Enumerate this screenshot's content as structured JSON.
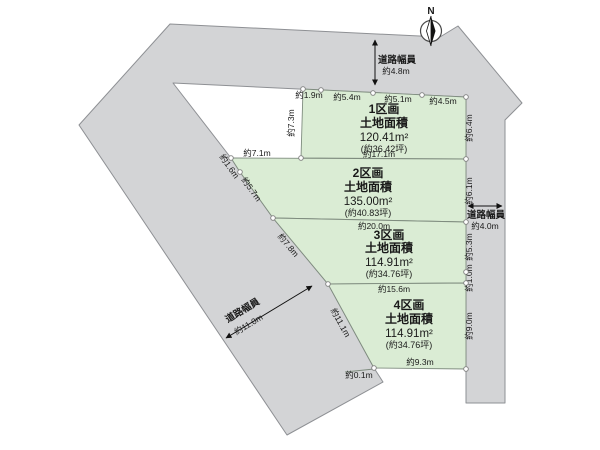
{
  "compass": {
    "north": "N"
  },
  "parcels": [
    {
      "name": "1区画",
      "area_title": "土地面積",
      "area": "120.41m²",
      "tsubo": "(約36.42坪)"
    },
    {
      "name": "2区画",
      "area_title": "土地面積",
      "area": "135.00m²",
      "tsubo": "(約40.83坪)"
    },
    {
      "name": "3区画",
      "area_title": "土地面積",
      "area": "114.91m²",
      "tsubo": "(約34.76坪)"
    },
    {
      "name": "4区画",
      "area_title": "土地面積",
      "area": "114.91m²",
      "tsubo": "(約34.76坪)"
    }
  ],
  "roads": {
    "top": {
      "label": "道路幅員",
      "width": "約4.8m"
    },
    "right": {
      "label": "道路幅員",
      "width": "約4.0m"
    },
    "bottom_left": {
      "label": "道路幅員",
      "width": "約11.0m"
    }
  },
  "dims": {
    "p1_top_1": "約1.9m",
    "p1_top_2": "約5.4m",
    "p1_top_3": "約5.1m",
    "p1_top_4": "約4.5m",
    "p1_left": "約7.3m",
    "p1_right": "約6.4m",
    "p1_bottom": "約17.1m",
    "notch_bottom": "約7.1m",
    "p2_left_1": "約1.6m",
    "p2_left_2": "約5.7m",
    "p2_right": "約6.1m",
    "p2_bottom": "約20.0m",
    "p3_left": "約7.8m",
    "p3_right_1": "約5.3m",
    "p3_right_2": "約1.0m",
    "p3_bottom": "約15.6m",
    "p4_left": "約11.1m",
    "p4_right": "約9.0m",
    "p4_bottom": "約9.3m",
    "p4_corner": "約0.1m"
  },
  "colors": {
    "road_fill": "#d3d4d6",
    "road_stroke": "#8e9094",
    "parcel_fill": "#daecd4",
    "parcel_stroke": "#7f8c7f",
    "text": "#1a1a1a"
  }
}
